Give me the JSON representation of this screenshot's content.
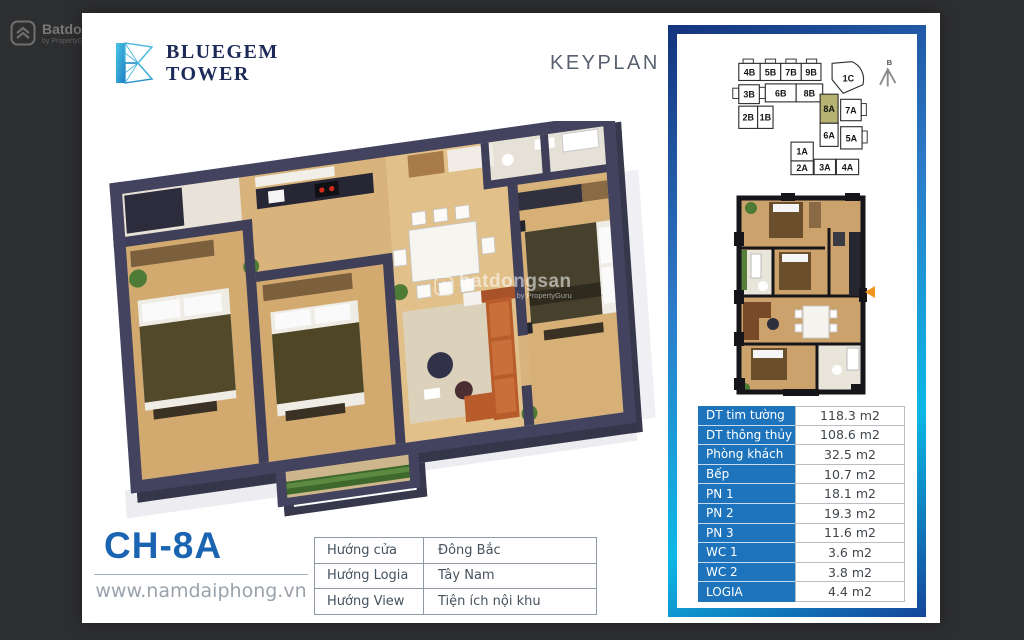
{
  "watermark": {
    "brand": "Batdongsan",
    "sub": "by PropertyGuru"
  },
  "card": {
    "logo": {
      "line1": "BLUEGEM",
      "line2": "TOWER"
    },
    "keyplan_title": "KEYPLAN",
    "unit_code": "CH-8A",
    "website": "www.namdaiphong.vn",
    "floorplan_watermark": {
      "brand": "batdongsan",
      "sub": "by PropertyGuru"
    },
    "keyplan": {
      "north_label": "B",
      "highlight_unit": "8A",
      "highlight_color": "#b6b271",
      "units": [
        "4B",
        "5B",
        "7B",
        "9B",
        "1C",
        "3B",
        "6B",
        "8B",
        "8A",
        "2B",
        "1B",
        "7A",
        "6A",
        "5A",
        "1A",
        "2A",
        "3A",
        "4A"
      ]
    },
    "direction_table": {
      "rows": [
        {
          "label": "Hướng cửa",
          "value": "Đông Bắc"
        },
        {
          "label": "Hướng Logia",
          "value": "Tây Nam"
        },
        {
          "label": "Hướng View",
          "value": "Tiện ích nội khu"
        }
      ]
    },
    "spec_table": {
      "header_bg": "#1d74bc",
      "rows": [
        {
          "label": "DT tim tường",
          "value": "118.3 m2"
        },
        {
          "label": "DT thông thủy",
          "value": "108.6 m2"
        },
        {
          "label": "Phòng khách",
          "value": "32.5 m2"
        },
        {
          "label": "Bếp",
          "value": "10.7 m2"
        },
        {
          "label": "PN 1",
          "value": "18.1 m2"
        },
        {
          "label": "PN 2",
          "value": "19.3 m2"
        },
        {
          "label": "PN 3",
          "value": "11.6 m2"
        },
        {
          "label": "WC 1",
          "value": "3.6 m2"
        },
        {
          "label": "WC 2",
          "value": "3.8 m2"
        },
        {
          "label": "LOGIA",
          "value": "4.4 m2"
        }
      ]
    }
  }
}
